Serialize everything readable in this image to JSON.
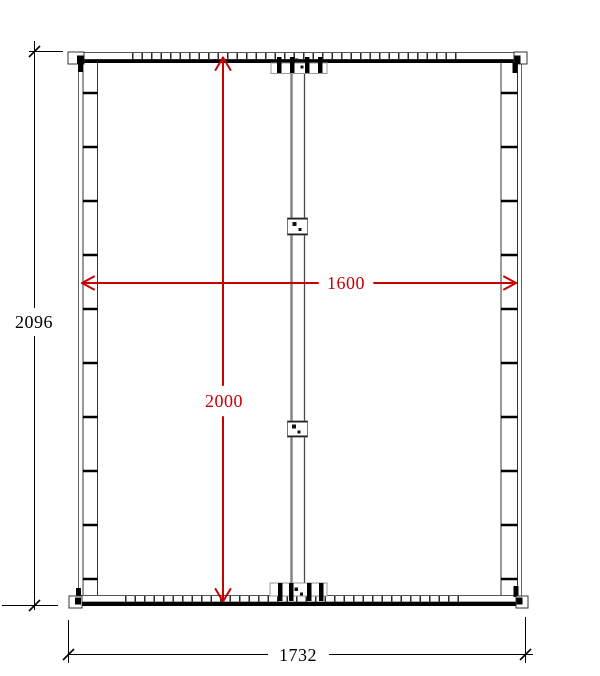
{
  "title": "Frame technical drawing",
  "dimensions": {
    "overall_height": "2096",
    "overall_width": "1732",
    "opening_width": "1600",
    "opening_height": "2000"
  },
  "colors": {
    "dimension_accent": "#c80000",
    "drawing_line": "#000000"
  }
}
